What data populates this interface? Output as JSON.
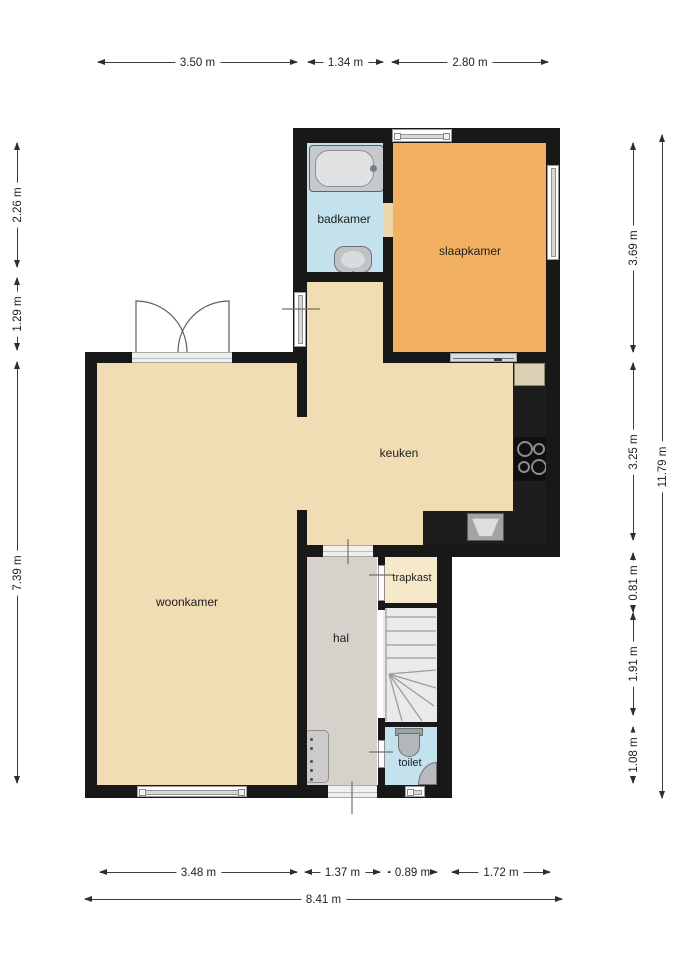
{
  "plan_title": "floor-plan-ground-floor",
  "rooms": {
    "badkamer": "badkamer",
    "slaapkamer": "slaapkamer",
    "keuken": "keuken",
    "woonkamer": "woonkamer",
    "hal": "hal",
    "trapkast": "trapkast",
    "toilet": "toilet"
  },
  "dimensions": {
    "top": [
      "3.50 m",
      "1.34 m",
      "2.80 m"
    ],
    "bottom": [
      "3.48 m",
      "1.37 m",
      "0.89 m",
      "1.72 m"
    ],
    "bottom_total": "8.41 m",
    "left": [
      "2.26 m",
      "1.29 m",
      "7.39 m"
    ],
    "right": [
      "3.69 m",
      "3.25 m",
      "0.81 m",
      "1.91 m",
      "1.08 m"
    ],
    "right_total": "11.79 m"
  },
  "colors": {
    "wall": "#181818",
    "floor": "#f0ddb4",
    "bedroom": "#f2b061",
    "bath": "#c3e2ee",
    "hall": "#d6d1ca",
    "closet": "#f6e9c9",
    "stairs": "#eaeaea",
    "counter": "#1d1d1d"
  }
}
